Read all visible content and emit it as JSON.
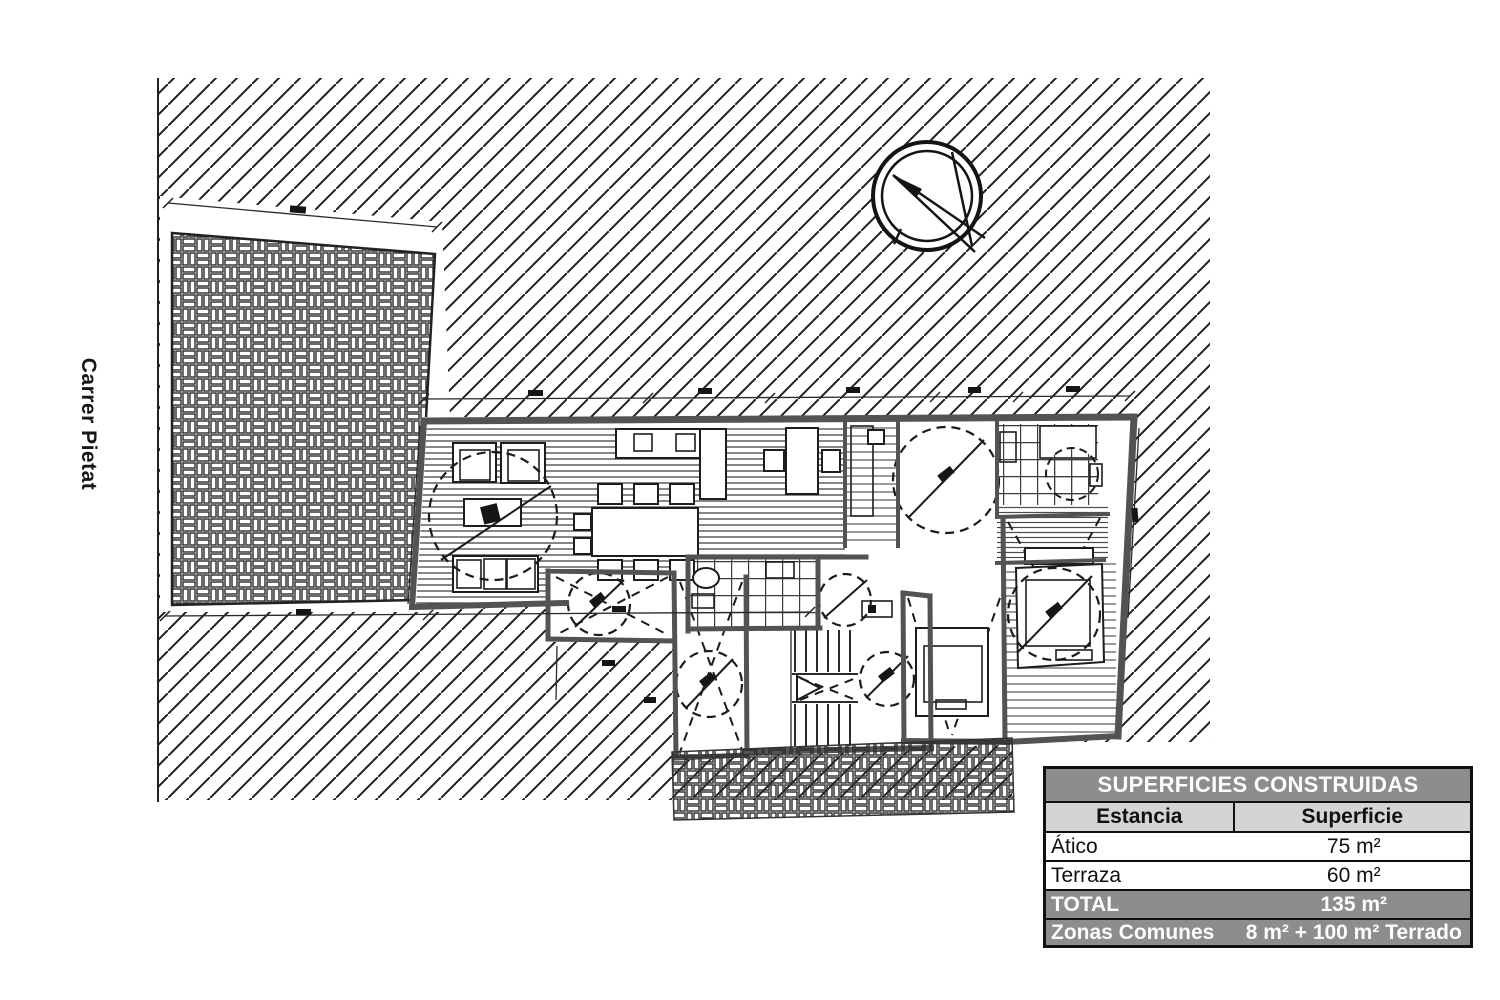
{
  "street_label": "Carrer Pietat",
  "plan": {
    "type": "architectural-floor-plan",
    "icons": {
      "compass": "north-compass-icon",
      "site_hatch": "diagonal-hatch-site-area",
      "paving": "basketweave-brick-paving"
    }
  },
  "table": {
    "title": "SUPERFICIES CONSTRUIDAS",
    "columns": {
      "estancia": "Estancia",
      "superficie": "Superficie"
    },
    "rows": [
      {
        "estancia": "Ático",
        "superficie": "75 m²"
      },
      {
        "estancia": "Terraza",
        "superficie": "60 m²"
      },
      {
        "estancia": "TOTAL",
        "superficie": "135 m²"
      },
      {
        "estancia": "Zonas Comunes",
        "superficie": "8 m² + 100 m² Terrado"
      }
    ]
  },
  "colors": {
    "table_header_bg": "#8d8d8d",
    "table_subheader_bg": "#d4d4d4",
    "table_highlight_bg": "#8d8d8d",
    "ink": "#151515",
    "wall_gray": "#535353",
    "paper": "#ffffff"
  }
}
